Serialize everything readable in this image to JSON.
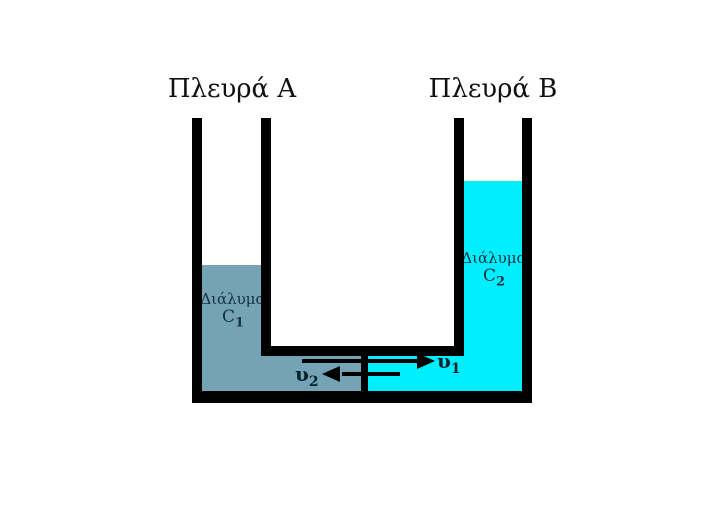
{
  "diagram": {
    "description": "U-tube with two solutions separated by a membrane at the bottom channel",
    "side_a": {
      "title": "Πλευρά A",
      "solution_name": "Διάλυμα",
      "concentration_symbol": "C",
      "concentration_sub": "1",
      "liquid_color": "#74a3b6"
    },
    "side_b": {
      "title": "Πλευρά B",
      "solution_name": "Διάλυμα",
      "concentration_symbol": "C",
      "concentration_sub": "2",
      "liquid_color": "#00efff"
    },
    "arrows": {
      "v1": {
        "symbol": "υ",
        "sub": "1",
        "direction": "right"
      },
      "v2": {
        "symbol": "υ",
        "sub": "2",
        "direction": "left"
      }
    },
    "colors": {
      "background": "#ffffff",
      "wall": "#000000",
      "arrow": "#000000",
      "solution_label_text": "#16303d",
      "title_text": "#111111"
    }
  }
}
